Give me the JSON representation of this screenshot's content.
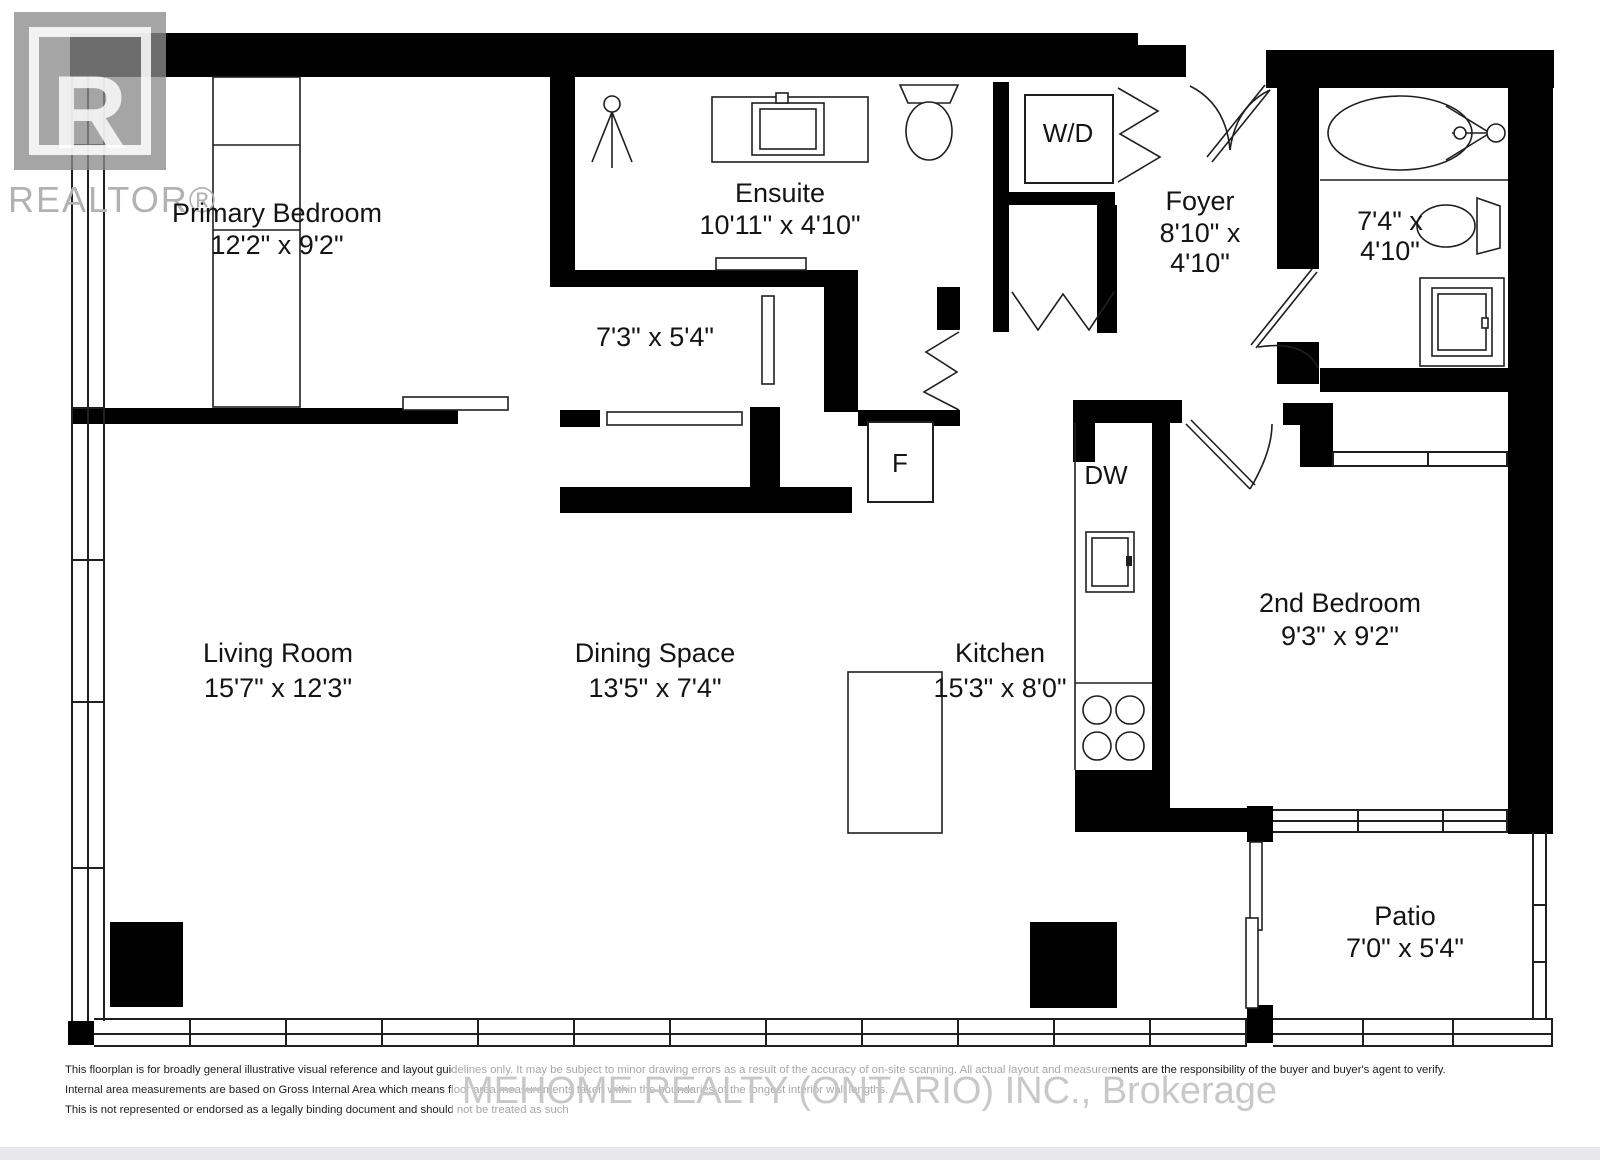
{
  "logo": {
    "letter": "R",
    "brand": "REALTOR®"
  },
  "rooms": {
    "primary_bedroom": {
      "name": "Primary Bedroom",
      "dims": "12'2\" x 9'2\""
    },
    "ensuite": {
      "name": "Ensuite",
      "dims": "10'11\" x 4'10\""
    },
    "closet": {
      "dims": "7'3\" x 5'4\""
    },
    "foyer": {
      "name": "Foyer",
      "dims1": "8'10\" x",
      "dims2": "4'10\""
    },
    "bathroom": {
      "dims1": "7'4\" x",
      "dims2": "4'10\""
    },
    "living_room": {
      "name": "Living Room",
      "dims": "15'7\" x 12'3\""
    },
    "dining_space": {
      "name": "Dining Space",
      "dims": "13'5\" x 7'4\""
    },
    "kitchen": {
      "name": "Kitchen",
      "dims": "15'3\" x 8'0\""
    },
    "second_bedroom": {
      "name": "2nd Bedroom",
      "dims": "9'3\" x 9'2\""
    },
    "patio": {
      "name": "Patio",
      "dims": "7'0\" x 5'4\""
    }
  },
  "appliances": {
    "washer_dryer": "W/D",
    "dishwasher": "DW",
    "fridge": "F"
  },
  "watermark": "MEHOME REALTY (ONTARIO) INC., Brokerage",
  "disclaimer": {
    "line1": "This floorplan is for broadly general illustrative visual reference and layout guidelines only.  It may be subject to minor drawing errors as a result of the accuracy of on-site scanning.  All actual layout and measurements are the responsibility of the buyer and buyer's agent to verify.",
    "line2": "Internal area measurements are based on Gross Internal Area which means floor area measurements taken within the boundaries of the longest interior wall lengths.",
    "line3": "This is not represented or endorsed as a legally binding document and should not be treated as such"
  },
  "colors": {
    "wall": "#000000",
    "line": "#1f1f1f",
    "logo_gray": "#9e9e9e",
    "watermark_gray": "#c6c6c6",
    "footer_strip": "#e8e8ec"
  }
}
